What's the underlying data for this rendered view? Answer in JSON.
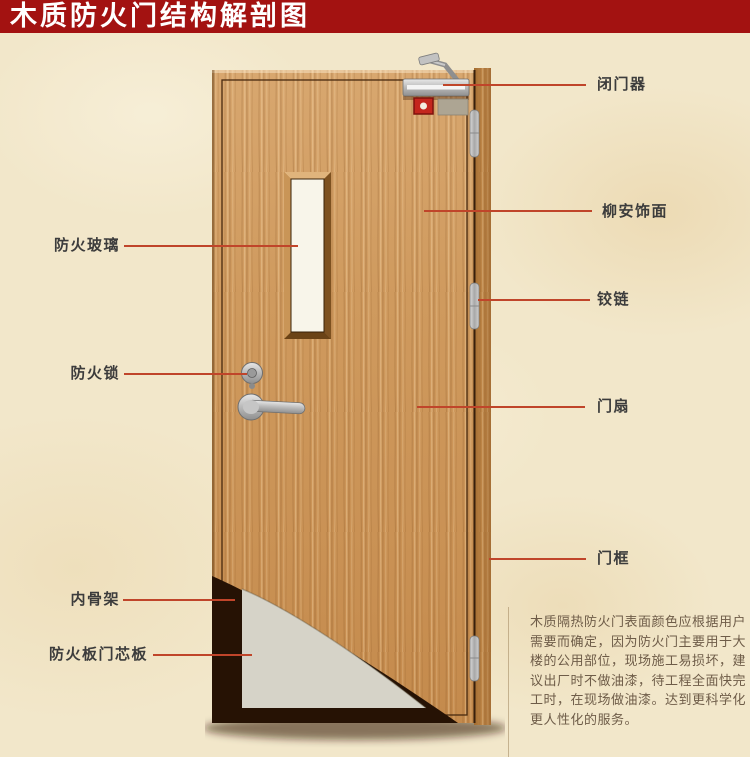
{
  "title": "木质防火门结构解剖图",
  "colors": {
    "banner_red": "#a31211",
    "callout_red": "#c0452a",
    "door_wood": "#cd9459",
    "frame_wood": "#b17a3c",
    "core_grey": "#d6d3c8",
    "inner_frame_dark": "#261204",
    "background_cream": "#f2e7ca"
  },
  "labels": {
    "left": [
      {
        "text": "防火玻璃"
      },
      {
        "text": "防火锁"
      },
      {
        "text": "内骨架"
      },
      {
        "text": "防火板门芯板"
      }
    ],
    "right": [
      {
        "text": "闭门器"
      },
      {
        "text": "柳安饰面"
      },
      {
        "text": "铰链"
      },
      {
        "text": "门扇"
      },
      {
        "text": "门框"
      }
    ]
  },
  "description": "木质隔热防火门表面颜色应根据用户\n需要而确定，因为防火门主要用于大\n楼的公用部位，现场施工易损坏，建\n议出厂时不做油漆，待工程全面快完\n工时，在现场做油漆。达到更科学化\n更人性化的服务。"
}
